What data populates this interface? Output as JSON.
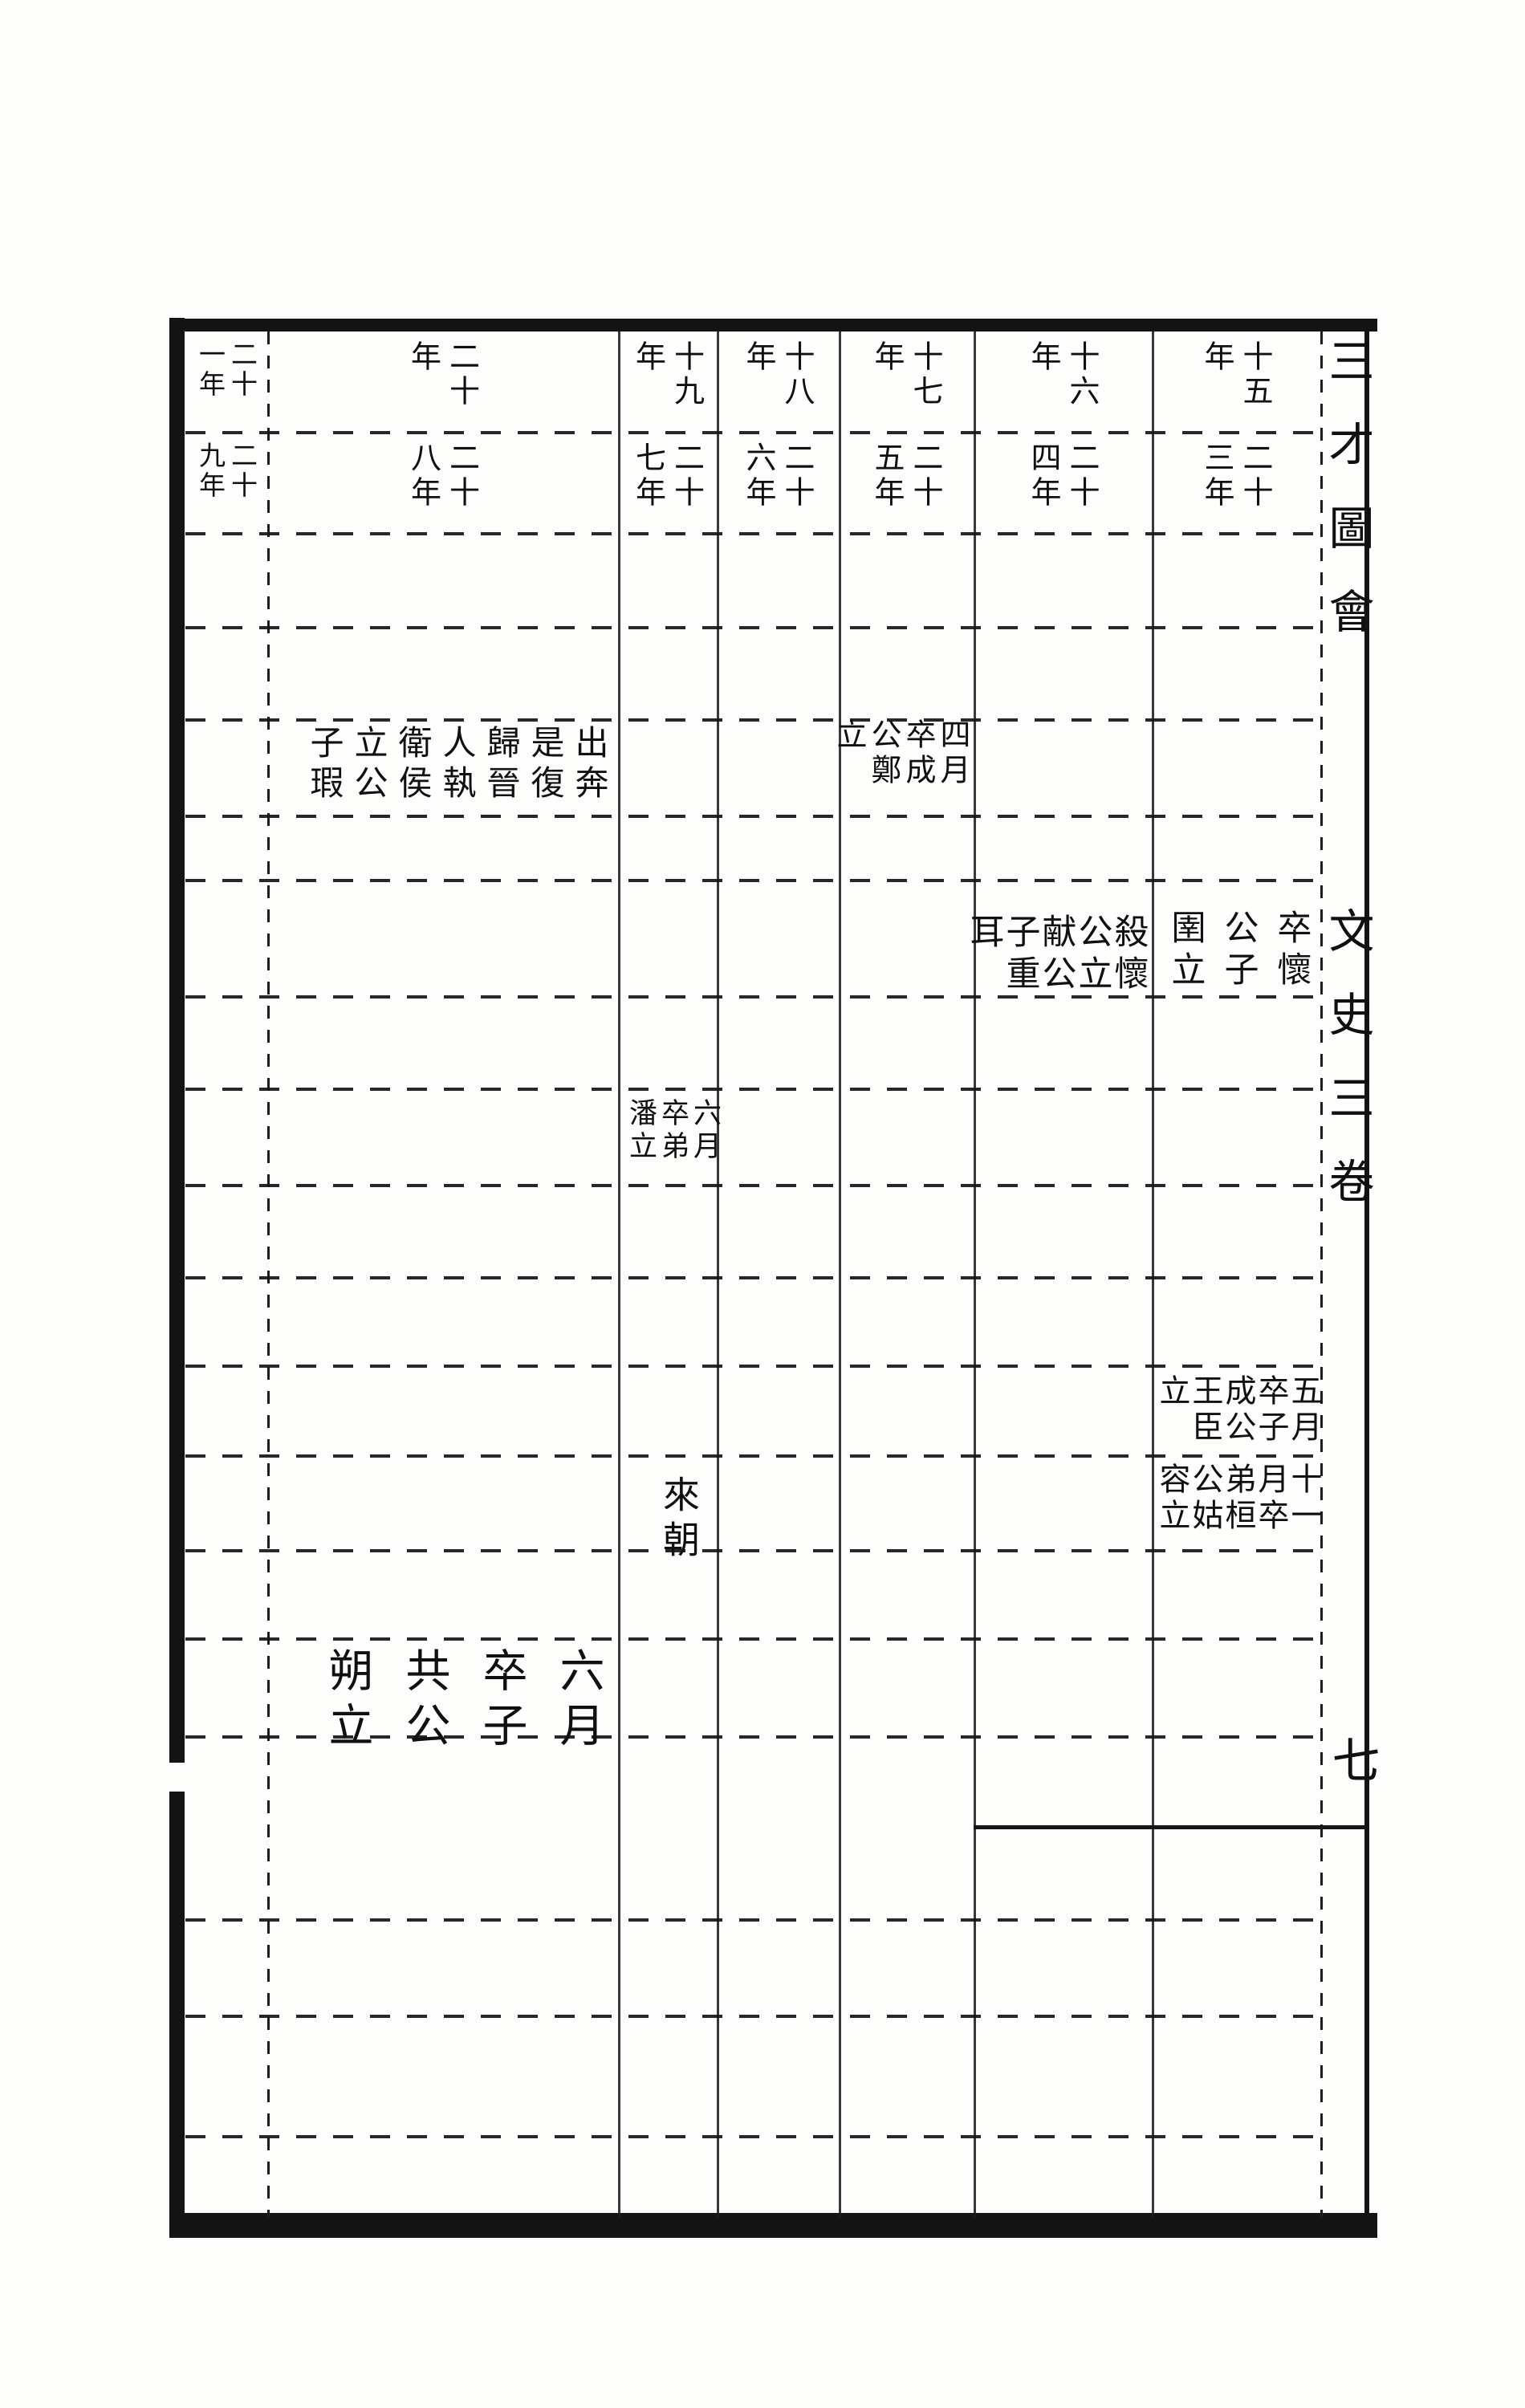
{
  "title_column": {
    "title": "三才圖會",
    "volume": "文史三卷",
    "page_number": "七"
  },
  "header": {
    "columns": [
      {
        "top": "十五年",
        "bottom": "二十三年"
      },
      {
        "top": "十六年",
        "bottom": "二十四年"
      },
      {
        "top": "十七年",
        "bottom": "二十五年"
      },
      {
        "top": "十八年",
        "bottom": "二十六年"
      },
      {
        "top": "十九年",
        "bottom": "二十七年"
      },
      {
        "top": "二十年",
        "bottom": "二十八年"
      },
      {
        "top": "二十一年",
        "bottom": "二十九年"
      }
    ]
  },
  "events": {
    "wei_y28": {
      "text": "出奔是復歸晉人執衛侯立公子瑕"
    },
    "wei_y25": {
      "text": "四月卒成公鄭立"
    },
    "jin_y23": {
      "text": "卒懷公子圉立"
    },
    "jin_y24": {
      "text": "殺懷公立献公子重耳"
    },
    "qi_y27": {
      "text": "六月卒弟潘立"
    },
    "song_y23": {
      "text": "五月卒子成公王臣立"
    },
    "qii_y23": {
      "text": "十一月卒弟桓公姑容立"
    },
    "qii_y27": {
      "text": "來朝"
    },
    "chen_y28": {
      "text": "六月卒子共公朔立"
    }
  },
  "ink_color": "#141414",
  "paper_color": "#fefefc"
}
